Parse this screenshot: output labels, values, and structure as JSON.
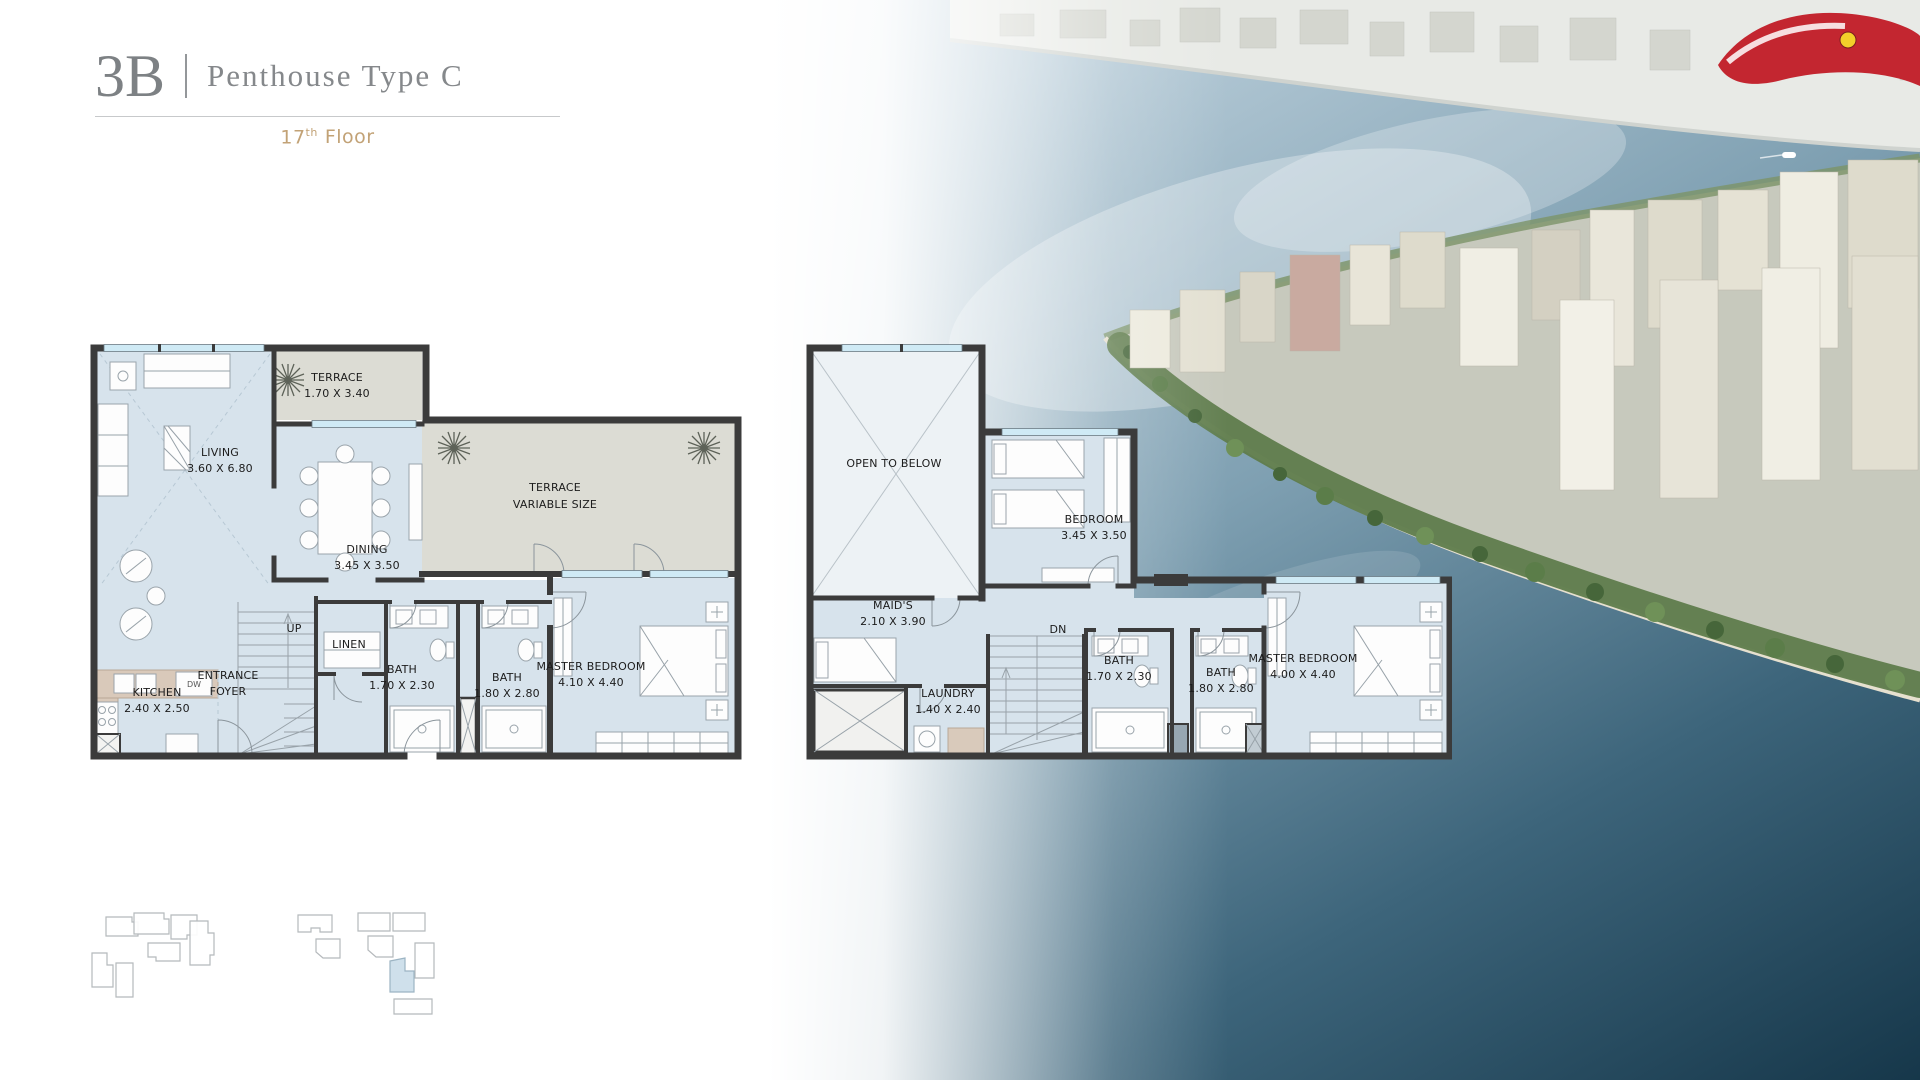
{
  "header": {
    "unit": "3B",
    "separator": "|",
    "title": "Penthouse Type C",
    "floor": {
      "number": "17",
      "ordinal": "th",
      "word": "Floor"
    }
  },
  "colors": {
    "accent_gold": "#c2a276",
    "title_gray": "#85888b",
    "floor_fill": "#d7e3ec",
    "terrace_fill": "#dcdcd4",
    "wall": "#3b3b3b",
    "window": "#cfeaf5",
    "water_deep": "#1a3c52",
    "keyplan_highlight": "#cfe0eb",
    "ferrari_roof_red": "#c32630"
  },
  "lower_plan": {
    "terrace_small": {
      "name": "TERRACE",
      "dims": "1.70 X 3.40"
    },
    "living": {
      "name": "LIVING",
      "dims": "3.60 X 6.80"
    },
    "dining": {
      "name": "DINING",
      "dims": "3.45 X 3.50"
    },
    "terrace_large": {
      "name": "TERRACE",
      "dims": "VARIABLE SIZE"
    },
    "kitchen": {
      "name": "KITCHEN",
      "dims": "2.40 X 2.50"
    },
    "entrance_foyer": {
      "line1": "ENTRANCE",
      "line2": "FOYER"
    },
    "stairs_label": "UP",
    "linen": {
      "name": "LINEN"
    },
    "bath_small": {
      "name": "BATH",
      "dims": "1.70 X 2.30"
    },
    "bath_large": {
      "name": "BATH",
      "dims": "1.80 X 2.80"
    },
    "master_bedroom": {
      "name": "MASTER BEDROOM",
      "dims": "4.10 X 4.40"
    },
    "appliance_label": "DW"
  },
  "upper_plan": {
    "open_to_below": {
      "name": "OPEN TO BELOW"
    },
    "bedroom": {
      "name": "BEDROOM",
      "dims": "3.45 X 3.50"
    },
    "maids": {
      "name": "MAID'S",
      "dims": "2.10 X 3.90"
    },
    "stairs_label": "DN",
    "laundry": {
      "name": "LAUNDRY",
      "dims": "1.40 X 2.40"
    },
    "bath_small": {
      "name": "BATH",
      "dims": "1.70 X 2.30"
    },
    "bath_large": {
      "name": "BATH",
      "dims": "1.80 X 2.80"
    },
    "master_bedroom": {
      "name": "MASTER BEDROOM",
      "dims": "4.00 X 4.40"
    }
  }
}
